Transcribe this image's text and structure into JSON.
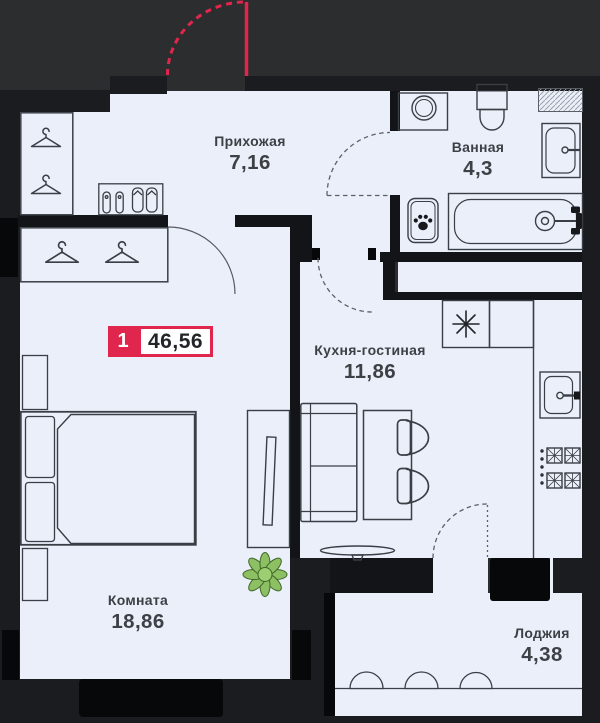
{
  "badge": {
    "rooms_count": "1",
    "total_area": "46,56"
  },
  "rooms": [
    {
      "id": "hallway",
      "name": "Прихожая",
      "area": "7,16"
    },
    {
      "id": "bathroom",
      "name": "Ванная",
      "area": "4,3"
    },
    {
      "id": "kitchen_living",
      "name": "Кухня-гостиная",
      "area": "11,86"
    },
    {
      "id": "room",
      "name": "Комната",
      "area": "18,86"
    },
    {
      "id": "loggia",
      "name": "Лоджия",
      "area": "4,38"
    }
  ],
  "colors": {
    "accent_red": "#e0264c",
    "floor": "#eaeffa",
    "wall": "#1b1c1f",
    "background": "#2c2d2f",
    "furniture_line": "#3a3f45",
    "plant_green": "#8cc063",
    "text": "#3d4045"
  },
  "icons": {
    "hanger": "hanger-icon",
    "paw": "paw-icon",
    "snowflake": "snowflake-icon",
    "plant": "plant-icon"
  }
}
